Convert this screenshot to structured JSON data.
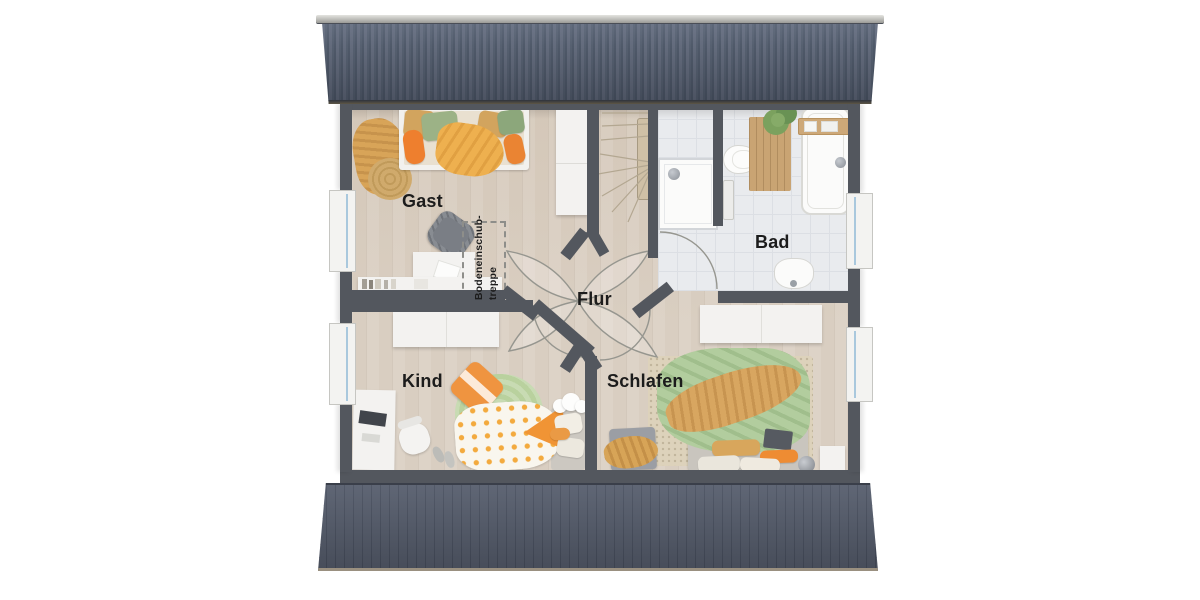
{
  "plan": {
    "rooms": [
      {
        "id": "gast",
        "label": "Gast"
      },
      {
        "id": "bad",
        "label": "Bad"
      },
      {
        "id": "flur",
        "label": "Flur"
      },
      {
        "id": "kind",
        "label": "Kind"
      },
      {
        "id": "schlafen",
        "label": "Schlafen"
      }
    ],
    "annotations": {
      "attic_stairs": "Bodeneinschub-\ntreppe"
    },
    "colors": {
      "wall": "#53575e",
      "wood_floor": "#d9cec1",
      "tile_floor": "#e9ebee",
      "roof_dark": "#4f5969",
      "roof_light": "#636b7c",
      "accent_orange": "#ee8c35",
      "accent_yellow": "#eeb04f",
      "accent_green": "#9cb286",
      "accent_mustard": "#d8a458",
      "rug_green": "#b9d19e",
      "white_furniture": "#f3f2f0",
      "label_ink": "#1c1c1c",
      "arc_line": "#96968f"
    }
  }
}
